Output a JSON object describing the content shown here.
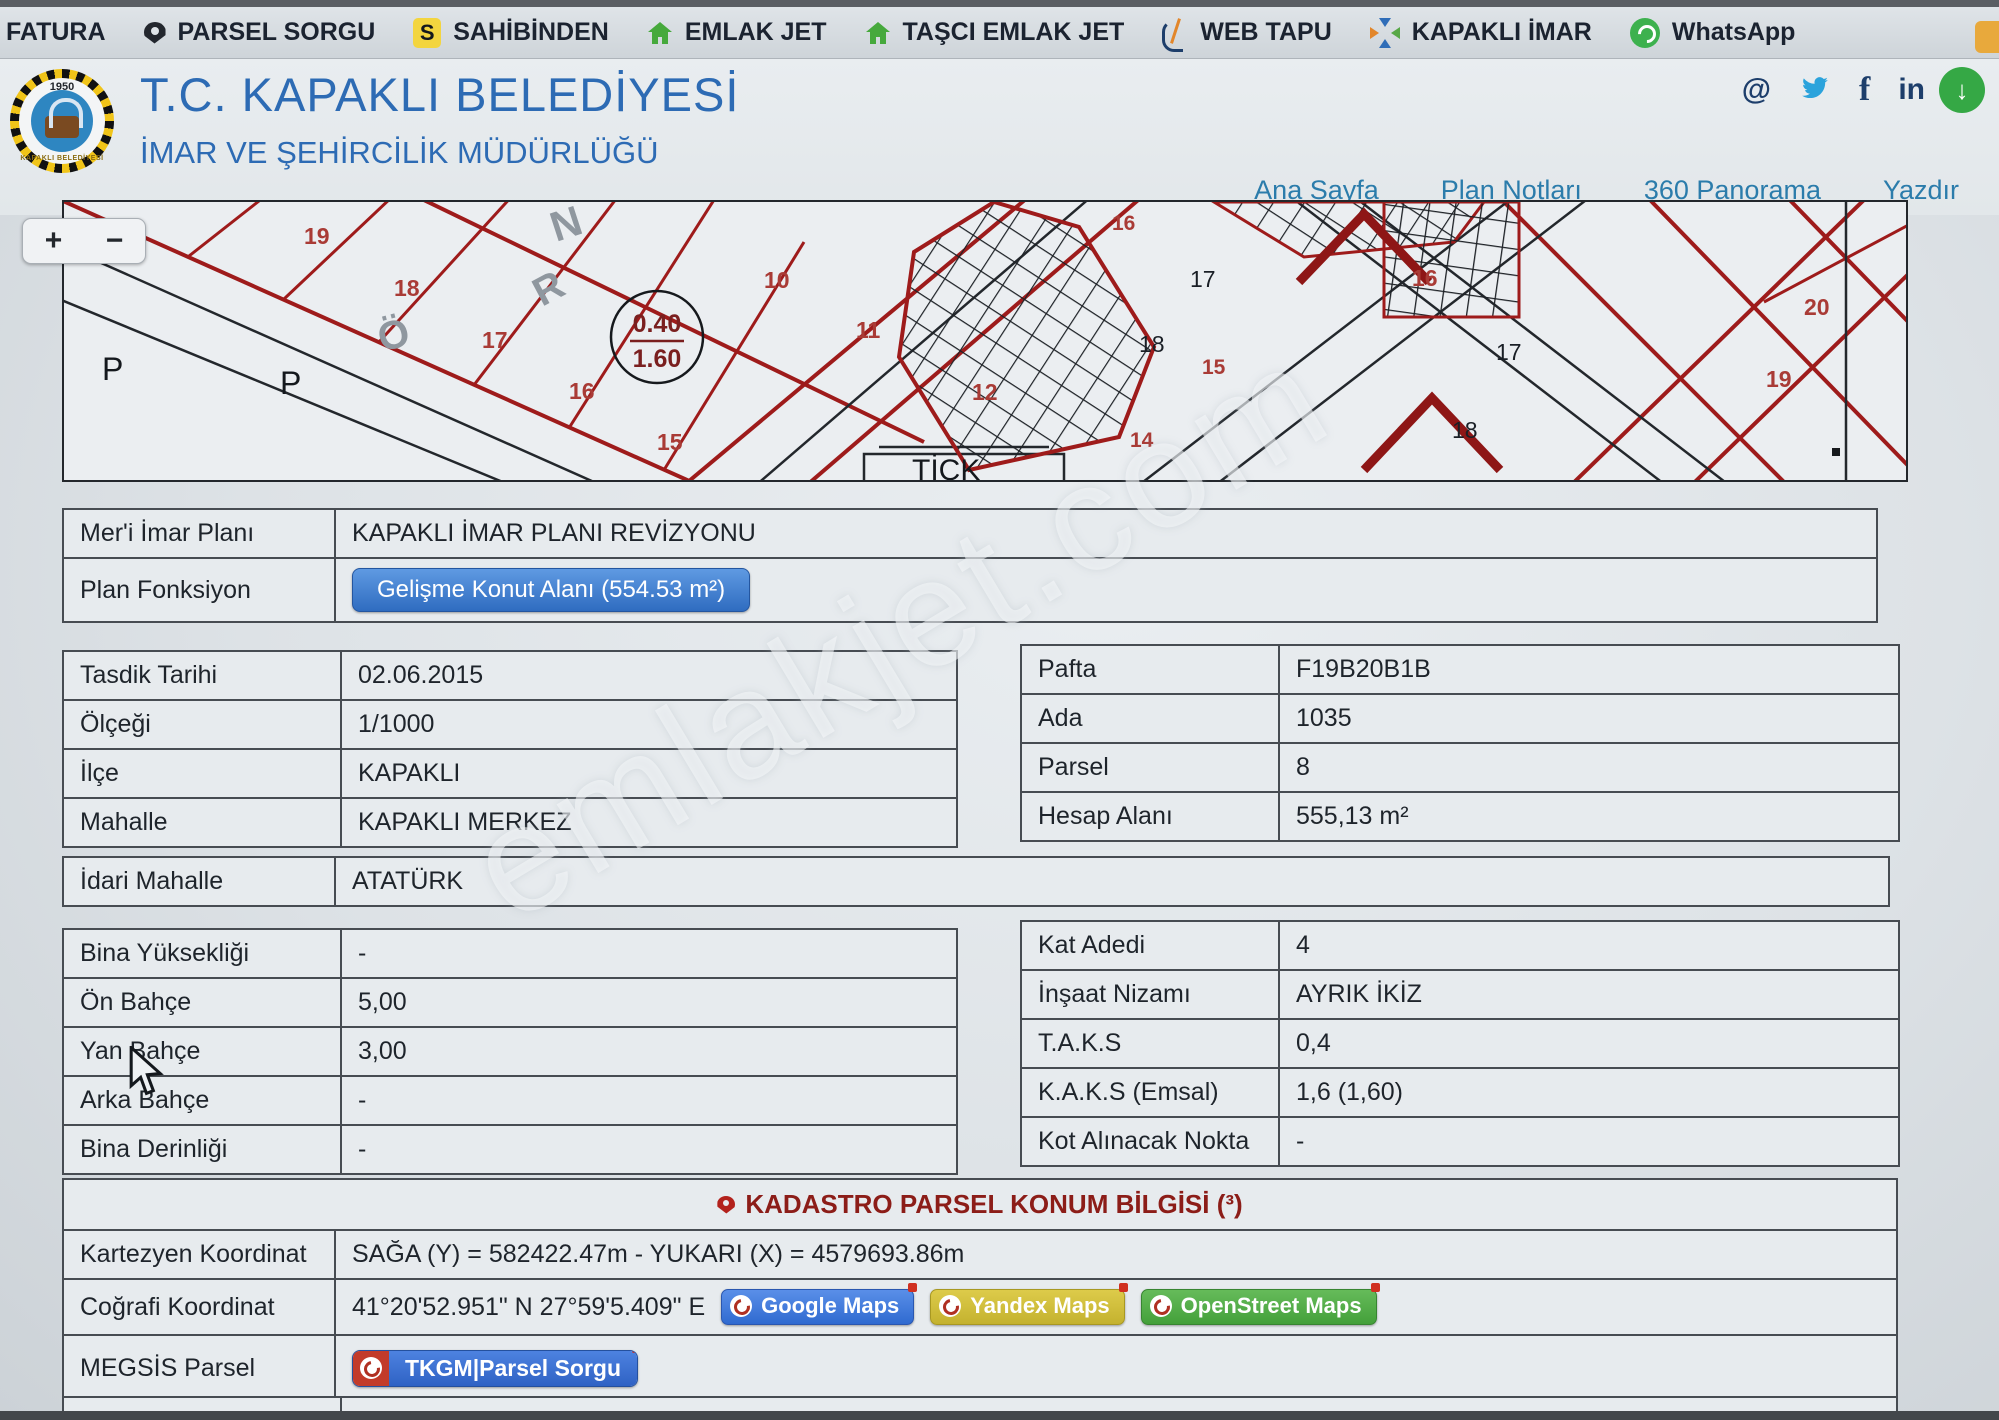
{
  "colors": {
    "accent_blue": "#2d6bb4",
    "nav_teal": "#2b7cab",
    "table_border": "#474c52",
    "parcel_red": "#9e1b1b",
    "label_red": "#a93b36",
    "kadastro_red": "#8c1d18",
    "button_blue": "#2f6cc0",
    "yandex_yellow": "#d0bd3a",
    "osm_green": "#4fae45",
    "whatsapp_green": "#3db14e"
  },
  "bookmarks_bar": {
    "items": [
      {
        "label": "FATURA",
        "icon": "none"
      },
      {
        "label": "PARSEL SORGU",
        "icon": "map-pin"
      },
      {
        "label": "SAHİBİNDEN",
        "icon": "s-badge",
        "badge_letter": "S"
      },
      {
        "label": "EMLAK JET",
        "icon": "green-house"
      },
      {
        "label": "TAŞCI EMLAK JET",
        "icon": "green-house"
      },
      {
        "label": "WEB TAPU",
        "icon": "webtapu-mark"
      },
      {
        "label": "KAPAKLI İMAR",
        "icon": "converging-arrows"
      },
      {
        "label": "WhatsApp",
        "icon": "whatsapp"
      }
    ]
  },
  "header": {
    "title": "T.C. KAPAKLI BELEDİYESİ",
    "subtitle": "İMAR VE ŞEHİRCİLİK MÜDÜRLÜĞÜ",
    "logo": {
      "year": "1950",
      "town": "KAPAKLI BELEDİYESİ"
    },
    "social_glyphs": {
      "at": "@",
      "facebook": "f",
      "linkedin": "in"
    },
    "download_arrow": "↓",
    "nav": [
      "Ana Sayfa",
      "Plan Notları",
      "360 Panorama",
      "Yazdır"
    ]
  },
  "map": {
    "zoom_in": "+",
    "zoom_out": "−",
    "labels": [
      {
        "t": "N"
      },
      {
        "t": "19"
      },
      {
        "t": "18"
      },
      {
        "t": "17"
      },
      {
        "t": "16"
      },
      {
        "t": "15"
      },
      {
        "t": "Ö"
      },
      {
        "t": "R"
      },
      {
        "t": "P"
      },
      {
        "t": "P"
      },
      {
        "t": "0.40"
      },
      {
        "t": "1.60"
      },
      {
        "t": "10"
      },
      {
        "t": "11"
      },
      {
        "t": "12"
      },
      {
        "t": "TİCK"
      },
      {
        "t": "16"
      },
      {
        "t": "17"
      },
      {
        "t": "18"
      },
      {
        "t": "15"
      },
      {
        "t": "14"
      },
      {
        "t": "16"
      },
      {
        "t": "17"
      },
      {
        "t": "18"
      },
      {
        "t": "20"
      },
      {
        "t": "19"
      }
    ]
  },
  "watermark": "emlakjet.com",
  "tables": {
    "plan": {
      "rows": [
        {
          "label": "Mer'i İmar Planı",
          "value": "KAPAKLI İMAR PLANI REVİZYONU"
        },
        {
          "label": "Plan Fonksiyon",
          "button": "Gelişme Konut Alanı (554.53 m²)"
        }
      ]
    },
    "left1": {
      "rows": [
        {
          "label": "Tasdik Tarihi",
          "value": "02.06.2015"
        },
        {
          "label": "Ölçeği",
          "value": "1/1000"
        },
        {
          "label": "İlçe",
          "value": "KAPAKLI"
        },
        {
          "label": "Mahalle",
          "value": "KAPAKLI MERKEZ"
        }
      ]
    },
    "right1": {
      "rows": [
        {
          "label": "Pafta",
          "value": "F19B20B1B"
        },
        {
          "label": "Ada",
          "value": "1035"
        },
        {
          "label": "Parsel",
          "value": "8"
        },
        {
          "label": "Hesap Alanı",
          "value": "555,13 m²"
        }
      ]
    },
    "idari": {
      "label": "İdari Mahalle",
      "value": "ATATÜRK"
    },
    "left2": {
      "rows": [
        {
          "label": "Bina Yüksekliği",
          "value": "-"
        },
        {
          "label": "Ön Bahçe",
          "value": "5,00"
        },
        {
          "label": "Yan Bahçe",
          "value": "3,00"
        },
        {
          "label": "Arka Bahçe",
          "value": "-"
        },
        {
          "label": "Bina Derinliği",
          "value": "-"
        }
      ]
    },
    "right2": {
      "rows": [
        {
          "label": "Kat Adedi",
          "value": "4"
        },
        {
          "label": "İnşaat Nizamı",
          "value": "AYRIK İKİZ"
        },
        {
          "label": "T.A.K.S",
          "value": "0,4"
        },
        {
          "label": "K.A.K.S (Emsal)",
          "value": "1,6 (1,60)"
        },
        {
          "label": "Kot Alınacak Nokta",
          "value": "-"
        }
      ]
    },
    "kadastro": {
      "title": "KADASTRO PARSEL KONUM BİLGİSİ (³)",
      "rows": [
        {
          "label": "Kartezyen Koordinat",
          "value": "SAĞA (Y) = 582422.47m - YUKARI (X) = 4579693.86m"
        },
        {
          "label": "Coğrafi Koordinat",
          "value": "41°20'52.951\" N 27°59'5.409\" E",
          "buttons": [
            "Google Maps",
            "Yandex Maps",
            "OpenStreet Maps"
          ]
        },
        {
          "label": "MEGSİS Parsel",
          "button": "TKGM|Parsel Sorgu"
        }
      ]
    },
    "aciklama": {
      "label": "Açıklama"
    }
  }
}
